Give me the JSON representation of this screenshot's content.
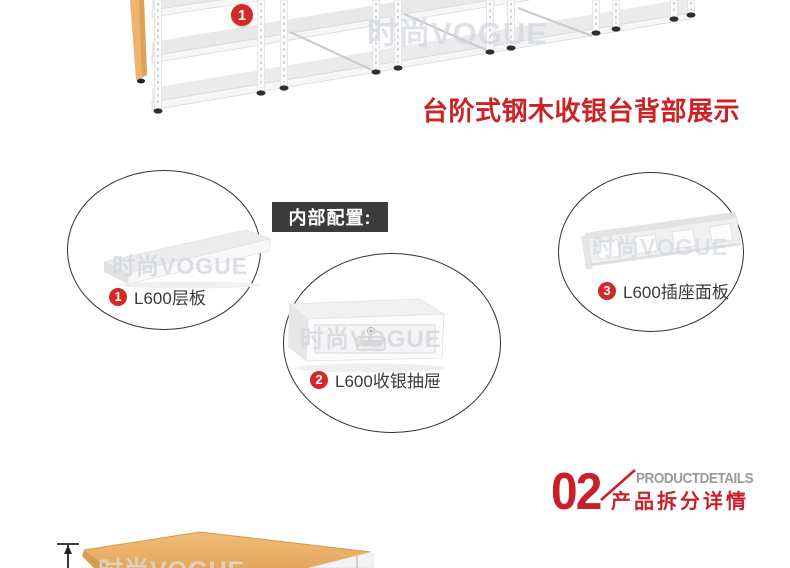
{
  "watermark": {
    "text": "时尚VOGUE"
  },
  "top_section": {
    "badge": "1",
    "heading": "台阶式钢木收银台背部展示"
  },
  "config_label": "内部配置:",
  "parts": [
    {
      "num": "1",
      "label": "L600层板"
    },
    {
      "num": "2",
      "label": "L600收银抽屉"
    },
    {
      "num": "3",
      "label": "L600插座面板"
    }
  ],
  "section_header": {
    "number": "02",
    "title_en": "PRODUCTDETAILS",
    "title_cn": "产品拆分详情"
  },
  "colors": {
    "accent_red": "#cc2226",
    "badge_red": "#d42828",
    "dark_label_bg": "#3b3b3b",
    "caption_gray": "#9a9a9a",
    "wood": "#ecb46c",
    "watermark_gray": "#d3d8df"
  }
}
